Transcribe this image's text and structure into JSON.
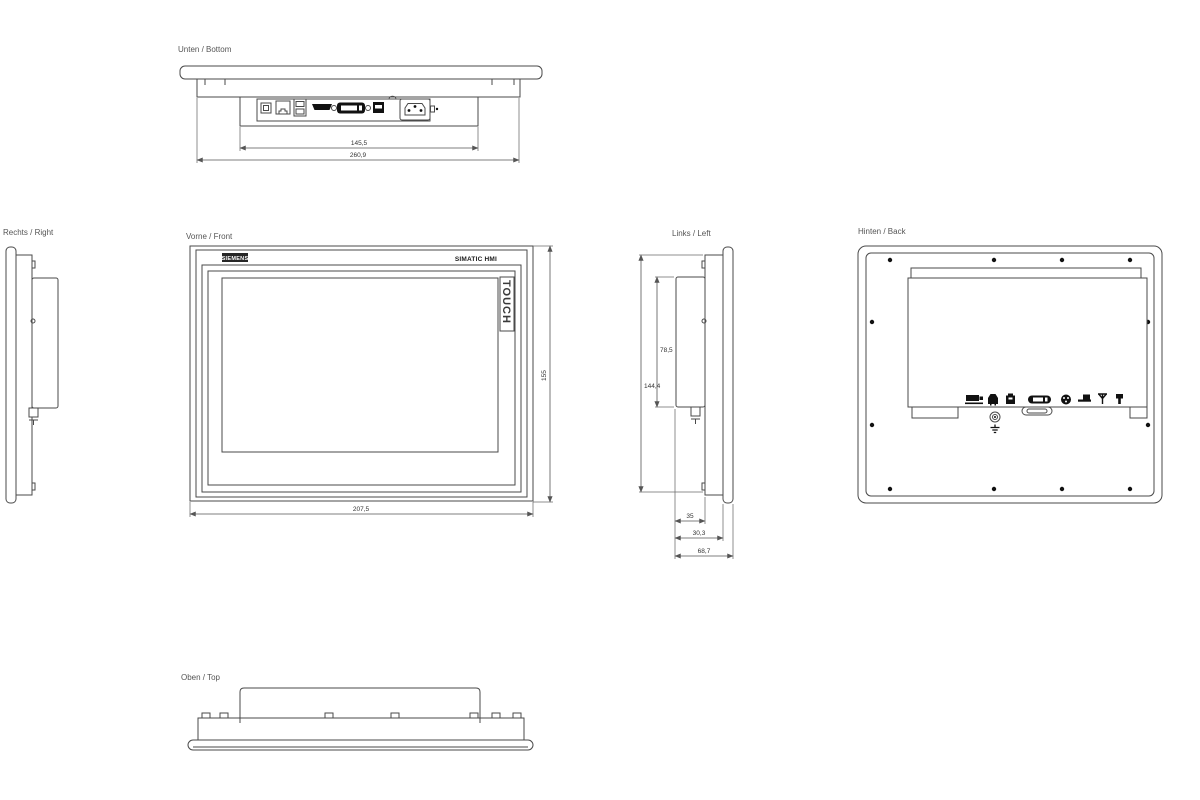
{
  "colors": {
    "background": "#ffffff",
    "line": "#4a4a4a",
    "label_text": "#555555",
    "dim_text": "#333333",
    "logo_bg": "#262626",
    "logo_text": "#ffffff",
    "glyph": "#111111"
  },
  "views": {
    "bottom": {
      "label": "Unten / Bottom",
      "dims": {
        "connector_area_width": "145,5",
        "overall_width": "260,9"
      },
      "port_icons": [
        "usb-b-port-icon",
        "ethernet-port-icon",
        "dual-usb-port-icon",
        "hdmi-port-icon",
        "dvi-port-icon",
        "usb-port-icon",
        "power-inlet-icon"
      ]
    },
    "right": {
      "label": "Rechts / Right"
    },
    "front": {
      "label": "Vorne / Front",
      "brand": "SIEMENS",
      "product": "SIMATIC HMI",
      "touch": "TOUCH",
      "dims": {
        "width": "207,5",
        "height": "155"
      }
    },
    "left": {
      "label": "Links / Left",
      "dims": {
        "body_height": "144,4",
        "rear_box_height": "78,5",
        "rear_box_depth": "35",
        "mid_depth": "30,3",
        "total_depth": "68,7"
      }
    },
    "back": {
      "label": "Hinten / Back",
      "port_icons": [
        "power-terminal-icon",
        "ethernet-port-icon",
        "usb-device-icon",
        "dvi-port-icon",
        "round-connector-icon",
        "usb-host-icon",
        "antenna-icon",
        "power-plug-icon"
      ],
      "ground_icon": "ground-terminal-icon"
    },
    "top": {
      "label": "Oben / Top"
    }
  }
}
